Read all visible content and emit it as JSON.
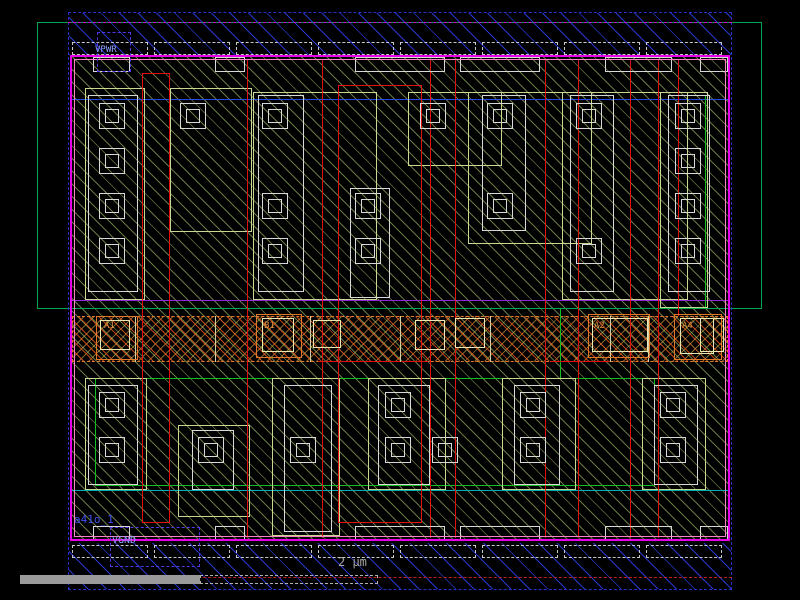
{
  "viewer": {
    "tool": "ic-layout-viewer",
    "cell_name": "a41o_1",
    "power_rails": [
      "VPWR",
      "VGND"
    ],
    "pin_labels": [
      "A1",
      "B1",
      "A2",
      "A4"
    ],
    "scale_bar": {
      "label": "2 μm"
    }
  },
  "colors": {
    "background": "#000000",
    "metal1_blue": "#2838d0",
    "boundary_blue": "#2830c8",
    "magenta_border": "#e800e8",
    "pink_inner": "#ff80c8",
    "magenta_dash": "#cc00cc",
    "red_dash": "#c02020",
    "nwell_green": "#00a850",
    "accent_green": "#10c020",
    "teal_line": "#00b0b0",
    "purple_line": "#9028d8",
    "blue_line": "#2848e8",
    "poly_red": "#e01010",
    "li_white": "#d8d8d8",
    "diff_tan": "#c8d890",
    "pin_bright": "#e8e8b0",
    "pin_orange": "#e07828",
    "label_orange": "#e09040",
    "label_blue": "#90a0ff",
    "cell_blue": "#4050f0",
    "ruler_gray": "#9a9a9a"
  },
  "shapes": [
    {
      "n": "m1-rail-top-hatch",
      "t": "rect",
      "x": 69,
      "y": 13,
      "w": 662,
      "h": 42,
      "f": "hb"
    },
    {
      "n": "m1-rail-bottom-hatch",
      "t": "rect",
      "x": 69,
      "y": 543,
      "w": 662,
      "h": 46,
      "f": "hb"
    },
    {
      "n": "cell-body-hatch",
      "t": "rect",
      "x": 72,
      "y": 57,
      "w": 656,
      "h": 484,
      "f": "hg"
    },
    {
      "n": "tap-band",
      "t": "rect",
      "x": 72,
      "y": 316,
      "w": 656,
      "h": 46,
      "f": "hx",
      "c": "#e07828",
      "s": "dashed"
    },
    {
      "n": "nwell-outline",
      "t": "rect",
      "x": 37,
      "y": 22,
      "w": 725,
      "h": 287,
      "c": "#00a850"
    },
    {
      "n": "implant-line-top",
      "t": "hline",
      "x": 72,
      "y": 99,
      "w": 656,
      "c": "#2848e8"
    },
    {
      "n": "well-boundary-line",
      "t": "hline",
      "x": 72,
      "y": 300,
      "w": 656,
      "c": "#9028d8"
    },
    {
      "n": "implant-line-bottom",
      "t": "hline",
      "x": 72,
      "y": 490,
      "w": 656,
      "c": "#00b0b0"
    },
    {
      "n": "green-edge-v1",
      "t": "vline",
      "x": 560,
      "y": 309,
      "h": 69,
      "c": "#10c020"
    },
    {
      "n": "green-edge-v2",
      "t": "vline",
      "x": 705,
      "y": 95,
      "h": 214,
      "c": "#10c020"
    },
    {
      "n": "lvt-region-outline",
      "t": "rect",
      "x": 95,
      "y": 378,
      "w": 560,
      "h": 108,
      "c": "#10c020"
    },
    {
      "n": "diff-outline-1",
      "t": "rect",
      "x": 85,
      "y": 88,
      "w": 60,
      "h": 212,
      "c": "#c8d890"
    },
    {
      "n": "diff-outline-2",
      "t": "rect",
      "x": 170,
      "y": 88,
      "w": 82,
      "h": 144,
      "c": "#c8d890"
    },
    {
      "n": "diff-outline-3",
      "t": "rect",
      "x": 253,
      "y": 92,
      "w": 124,
      "h": 208,
      "c": "#c8d890"
    },
    {
      "n": "diff-outline-4",
      "t": "rect",
      "x": 408,
      "y": 92,
      "w": 94,
      "h": 74,
      "c": "#c8d890"
    },
    {
      "n": "diff-outline-5",
      "t": "rect",
      "x": 468,
      "y": 92,
      "w": 124,
      "h": 152,
      "c": "#c8d890"
    },
    {
      "n": "diff-outline-6",
      "t": "rect",
      "x": 562,
      "y": 92,
      "w": 126,
      "h": 208,
      "c": "#c8d890"
    },
    {
      "n": "diff-outline-7",
      "t": "rect",
      "x": 660,
      "y": 92,
      "w": 48,
      "h": 216,
      "c": "#c8d890"
    },
    {
      "n": "diff-outline-8",
      "t": "rect",
      "x": 85,
      "y": 378,
      "w": 62,
      "h": 112,
      "c": "#c8d890"
    },
    {
      "n": "diff-outline-9",
      "t": "rect",
      "x": 178,
      "y": 425,
      "w": 72,
      "h": 92,
      "c": "#c8d890"
    },
    {
      "n": "diff-outline-10",
      "t": "rect",
      "x": 272,
      "y": 378,
      "w": 68,
      "h": 158,
      "c": "#c8d890"
    },
    {
      "n": "diff-outline-11",
      "t": "rect",
      "x": 368,
      "y": 378,
      "w": 78,
      "h": 112,
      "c": "#c8d890"
    },
    {
      "n": "diff-outline-12",
      "t": "rect",
      "x": 502,
      "y": 378,
      "w": 74,
      "h": 112,
      "c": "#c8d890"
    },
    {
      "n": "diff-outline-13",
      "t": "rect",
      "x": 642,
      "y": 378,
      "w": 64,
      "h": 112,
      "c": "#c8d890"
    },
    {
      "n": "poly-pad-pair-1",
      "t": "rect",
      "x": 142,
      "y": 73,
      "w": 28,
      "h": 450,
      "c": "#e01010"
    },
    {
      "n": "poly-pad-pair-2",
      "t": "rect",
      "x": 338,
      "y": 85,
      "w": 84,
      "h": 438,
      "c": "#e01010"
    },
    {
      "n": "poly-gate-1",
      "t": "vline",
      "x": 247,
      "y": 60,
      "h": 478,
      "c": "#e01010"
    },
    {
      "n": "poly-gate-2",
      "t": "vline",
      "x": 322,
      "y": 60,
      "h": 478,
      "c": "#e01010"
    },
    {
      "n": "poly-gate-3",
      "t": "vline",
      "x": 430,
      "y": 60,
      "h": 478,
      "c": "#e01010"
    },
    {
      "n": "poly-gate-4",
      "t": "vline",
      "x": 455,
      "y": 60,
      "h": 478,
      "c": "#e01010"
    },
    {
      "n": "poly-gate-5",
      "t": "vline",
      "x": 545,
      "y": 60,
      "h": 478,
      "c": "#e01010"
    },
    {
      "n": "poly-gate-6",
      "t": "vline",
      "x": 578,
      "y": 60,
      "h": 478,
      "c": "#e01010"
    },
    {
      "n": "poly-gate-7",
      "t": "vline",
      "x": 630,
      "y": 60,
      "h": 478,
      "c": "#e01010"
    },
    {
      "n": "poly-gate-8",
      "t": "vline",
      "x": 658,
      "y": 60,
      "h": 478,
      "c": "#e01010"
    },
    {
      "n": "poly-gate-9",
      "t": "vline",
      "x": 678,
      "y": 60,
      "h": 256,
      "c": "#e01010"
    },
    {
      "n": "poly-seg-1",
      "t": "hline",
      "x": 318,
      "y": 361,
      "w": 110,
      "c": "#e01010"
    },
    {
      "n": "poly-seg-2",
      "t": "hline",
      "x": 550,
      "y": 361,
      "w": 60,
      "c": "#e01010"
    },
    {
      "n": "li-finger-1",
      "t": "rect",
      "x": 88,
      "y": 95,
      "w": 50,
      "h": 197,
      "c": "#d8d8d8"
    },
    {
      "n": "li-finger-2",
      "t": "rect",
      "x": 258,
      "y": 95,
      "w": 46,
      "h": 197,
      "c": "#d8d8d8"
    },
    {
      "n": "li-finger-3",
      "t": "rect",
      "x": 350,
      "y": 188,
      "w": 40,
      "h": 110,
      "c": "#d8d8d8"
    },
    {
      "n": "li-finger-4",
      "t": "rect",
      "x": 482,
      "y": 95,
      "w": 44,
      "h": 136,
      "c": "#d8d8d8"
    },
    {
      "n": "li-finger-5",
      "t": "rect",
      "x": 570,
      "y": 95,
      "w": 44,
      "h": 197,
      "c": "#d8d8d8"
    },
    {
      "n": "li-finger-6",
      "t": "rect",
      "x": 668,
      "y": 95,
      "w": 42,
      "h": 197,
      "c": "#d8d8d8"
    },
    {
      "n": "li-finger-7",
      "t": "rect",
      "x": 88,
      "y": 385,
      "w": 50,
      "h": 100,
      "c": "#d8d8d8"
    },
    {
      "n": "li-finger-8",
      "t": "rect",
      "x": 192,
      "y": 430,
      "w": 42,
      "h": 60,
      "c": "#d8d8d8"
    },
    {
      "n": "li-finger-9",
      "t": "rect",
      "x": 284,
      "y": 385,
      "w": 48,
      "h": 147,
      "c": "#d8d8d8"
    },
    {
      "n": "li-finger-10",
      "t": "rect",
      "x": 378,
      "y": 385,
      "w": 52,
      "h": 100,
      "c": "#d8d8d8"
    },
    {
      "n": "li-finger-11",
      "t": "rect",
      "x": 514,
      "y": 385,
      "w": 46,
      "h": 100,
      "c": "#d8d8d8"
    },
    {
      "n": "li-finger-12",
      "t": "rect",
      "x": 654,
      "y": 385,
      "w": 44,
      "h": 100,
      "c": "#d8d8d8"
    },
    {
      "n": "rail-tab-t1",
      "t": "rect",
      "x": 93,
      "y": 57,
      "w": 37,
      "h": 15,
      "c": "#d8d8d8"
    },
    {
      "n": "rail-tab-t2",
      "t": "rect",
      "x": 215,
      "y": 57,
      "w": 30,
      "h": 15,
      "c": "#d8d8d8"
    },
    {
      "n": "rail-tab-t3",
      "t": "rect",
      "x": 355,
      "y": 57,
      "w": 90,
      "h": 15,
      "c": "#d8d8d8"
    },
    {
      "n": "rail-tab-t4",
      "t": "rect",
      "x": 460,
      "y": 57,
      "w": 80,
      "h": 15,
      "c": "#d8d8d8"
    },
    {
      "n": "rail-tab-t5",
      "t": "rect",
      "x": 605,
      "y": 57,
      "w": 67,
      "h": 15,
      "c": "#d8d8d8"
    },
    {
      "n": "rail-tab-t6",
      "t": "rect",
      "x": 700,
      "y": 57,
      "w": 28,
      "h": 15,
      "c": "#d8d8d8"
    },
    {
      "n": "rail-tab-b1",
      "t": "rect",
      "x": 93,
      "y": 526,
      "w": 37,
      "h": 15,
      "c": "#d8d8d8"
    },
    {
      "n": "rail-tab-b2",
      "t": "rect",
      "x": 215,
      "y": 526,
      "w": 30,
      "h": 15,
      "c": "#d8d8d8"
    },
    {
      "n": "rail-tab-b3",
      "t": "rect",
      "x": 355,
      "y": 526,
      "w": 90,
      "h": 15,
      "c": "#d8d8d8"
    },
    {
      "n": "rail-tab-b4",
      "t": "rect",
      "x": 460,
      "y": 526,
      "w": 80,
      "h": 15,
      "c": "#d8d8d8"
    },
    {
      "n": "rail-tab-b5",
      "t": "rect",
      "x": 605,
      "y": 526,
      "w": 67,
      "h": 15,
      "c": "#d8d8d8"
    },
    {
      "n": "rail-tab-b6",
      "t": "rect",
      "x": 700,
      "y": 526,
      "w": 28,
      "h": 15,
      "c": "#d8d8d8"
    },
    {
      "n": "tap-vline-1",
      "t": "vline",
      "x": 135,
      "y": 316,
      "h": 46,
      "c": "#d0d0a0"
    },
    {
      "n": "tap-vline-2",
      "t": "vline",
      "x": 215,
      "y": 316,
      "h": 46,
      "c": "#d0d0a0"
    },
    {
      "n": "tap-vline-3",
      "t": "vline",
      "x": 310,
      "y": 316,
      "h": 46,
      "c": "#d0d0a0"
    },
    {
      "n": "tap-vline-4",
      "t": "vline",
      "x": 400,
      "y": 316,
      "h": 46,
      "c": "#d0d0a0"
    },
    {
      "n": "tap-vline-5",
      "t": "vline",
      "x": 490,
      "y": 316,
      "h": 46,
      "c": "#d0d0a0"
    },
    {
      "n": "tap-vline-6",
      "t": "vline",
      "x": 610,
      "y": 316,
      "h": 46,
      "c": "#d0d0a0"
    },
    {
      "n": "tap-vline-7",
      "t": "vline",
      "x": 648,
      "y": 316,
      "h": 46,
      "c": "#d0d0a0"
    },
    {
      "n": "contact",
      "t": "sq",
      "x": 99,
      "y": 103
    },
    {
      "n": "contact",
      "t": "sq",
      "x": 99,
      "y": 148
    },
    {
      "n": "contact",
      "t": "sq",
      "x": 99,
      "y": 193
    },
    {
      "n": "contact",
      "t": "sq",
      "x": 99,
      "y": 238
    },
    {
      "n": "contact",
      "t": "sq",
      "x": 180,
      "y": 103
    },
    {
      "n": "contact",
      "t": "sq",
      "x": 262,
      "y": 103
    },
    {
      "n": "contact",
      "t": "sq",
      "x": 262,
      "y": 193
    },
    {
      "n": "contact",
      "t": "sq",
      "x": 262,
      "y": 238
    },
    {
      "n": "contact",
      "t": "sq",
      "x": 355,
      "y": 193
    },
    {
      "n": "contact",
      "t": "sq",
      "x": 355,
      "y": 238
    },
    {
      "n": "contact",
      "t": "sq",
      "x": 420,
      "y": 103
    },
    {
      "n": "contact",
      "t": "sq",
      "x": 487,
      "y": 103
    },
    {
      "n": "contact",
      "t": "sq",
      "x": 487,
      "y": 193
    },
    {
      "n": "contact",
      "t": "sq",
      "x": 576,
      "y": 103
    },
    {
      "n": "contact",
      "t": "sq",
      "x": 576,
      "y": 238
    },
    {
      "n": "contact",
      "t": "sq",
      "x": 675,
      "y": 103
    },
    {
      "n": "contact",
      "t": "sq",
      "x": 675,
      "y": 148
    },
    {
      "n": "contact",
      "t": "sq",
      "x": 675,
      "y": 193
    },
    {
      "n": "contact",
      "t": "sq",
      "x": 675,
      "y": 238
    },
    {
      "n": "contact",
      "t": "sq",
      "x": 99,
      "y": 392
    },
    {
      "n": "contact",
      "t": "sq",
      "x": 99,
      "y": 437
    },
    {
      "n": "contact",
      "t": "sq",
      "x": 198,
      "y": 437
    },
    {
      "n": "contact",
      "t": "sq",
      "x": 290,
      "y": 437
    },
    {
      "n": "contact",
      "t": "sq",
      "x": 385,
      "y": 392
    },
    {
      "n": "contact",
      "t": "sq",
      "x": 385,
      "y": 437
    },
    {
      "n": "contact",
      "t": "sq",
      "x": 432,
      "y": 437
    },
    {
      "n": "contact",
      "t": "sq",
      "x": 520,
      "y": 392
    },
    {
      "n": "contact",
      "t": "sq",
      "x": 520,
      "y": 437
    },
    {
      "n": "contact",
      "t": "sq",
      "x": 660,
      "y": 392
    },
    {
      "n": "contact",
      "t": "sq",
      "x": 660,
      "y": 437
    },
    {
      "n": "pin-box-a1",
      "t": "rect",
      "x": 96,
      "y": 316,
      "w": 42,
      "h": 44,
      "c": "#e07828"
    },
    {
      "n": "pin-box-b1",
      "t": "rect",
      "x": 256,
      "y": 314,
      "w": 46,
      "h": 44,
      "c": "#e07828"
    },
    {
      "n": "pin-box-a2",
      "t": "rect",
      "x": 588,
      "y": 314,
      "w": 62,
      "h": 44,
      "c": "#e07828"
    },
    {
      "n": "pin-box-a4",
      "t": "rect",
      "x": 674,
      "y": 314,
      "w": 48,
      "h": 46,
      "c": "#e07828"
    },
    {
      "n": "pin-li-a1",
      "t": "rect",
      "x": 100,
      "y": 320,
      "w": 30,
      "h": 30,
      "c": "#e8e8b0"
    },
    {
      "n": "pin-li-b1",
      "t": "rect",
      "x": 262,
      "y": 318,
      "w": 32,
      "h": 34,
      "c": "#e8e8b0"
    },
    {
      "n": "pin-li-a2",
      "t": "rect",
      "x": 592,
      "y": 318,
      "w": 56,
      "h": 34,
      "c": "#e8e8b0"
    },
    {
      "n": "pin-li-a4",
      "t": "rect",
      "x": 680,
      "y": 318,
      "w": 34,
      "h": 36,
      "c": "#e8e8b0"
    },
    {
      "n": "tap-li-1",
      "t": "rect",
      "x": 313,
      "y": 320,
      "w": 28,
      "h": 28,
      "c": "#e8e8b0"
    },
    {
      "n": "tap-li-2",
      "t": "rect",
      "x": 415,
      "y": 320,
      "w": 30,
      "h": 30,
      "c": "#e8e8b0"
    },
    {
      "n": "tap-li-3",
      "t": "rect",
      "x": 455,
      "y": 318,
      "w": 30,
      "h": 30,
      "c": "#e8e8b0"
    },
    {
      "n": "tap-li-4",
      "t": "rect",
      "x": 700,
      "y": 318,
      "w": 24,
      "h": 34,
      "c": "#e8e8b0"
    },
    {
      "n": "cell-border-magenta",
      "t": "rect",
      "x": 70,
      "y": 55,
      "w": 660,
      "h": 486,
      "c": "#e800e8",
      "bw": 2
    },
    {
      "n": "cell-border-pink",
      "t": "rect",
      "x": 74,
      "y": 59,
      "w": 652,
      "h": 478,
      "c": "#ff80c8"
    },
    {
      "n": "boundary-blue-dashed",
      "t": "rect",
      "x": 68,
      "y": 12,
      "w": 664,
      "h": 578,
      "c": "#2830c8",
      "s": "dashed"
    },
    {
      "n": "rail-centerline-top",
      "t": "hdash",
      "x": 68,
      "y": 22,
      "w": 664,
      "c": "#cc00cc"
    },
    {
      "n": "rail-centerline-bottom",
      "t": "hdash",
      "x": 68,
      "y": 577,
      "w": 664,
      "c": "#c02020"
    },
    {
      "n": "mcon-row-t1",
      "t": "rect",
      "x": 72,
      "y": 42,
      "w": 76,
      "h": 13,
      "c": "#c8c8c8",
      "s": "dashed"
    },
    {
      "n": "mcon-row-t2",
      "t": "rect",
      "x": 154,
      "y": 42,
      "w": 76,
      "h": 13,
      "c": "#c8c8c8",
      "s": "dashed"
    },
    {
      "n": "mcon-row-t3",
      "t": "rect",
      "x": 236,
      "y": 42,
      "w": 76,
      "h": 13,
      "c": "#c8c8c8",
      "s": "dashed"
    },
    {
      "n": "mcon-row-t4",
      "t": "rect",
      "x": 318,
      "y": 42,
      "w": 76,
      "h": 13,
      "c": "#c8c8c8",
      "s": "dashed"
    },
    {
      "n": "mcon-row-t5",
      "t": "rect",
      "x": 400,
      "y": 42,
      "w": 76,
      "h": 13,
      "c": "#c8c8c8",
      "s": "dashed"
    },
    {
      "n": "mcon-row-t6",
      "t": "rect",
      "x": 482,
      "y": 42,
      "w": 76,
      "h": 13,
      "c": "#c8c8c8",
      "s": "dashed"
    },
    {
      "n": "mcon-row-t7",
      "t": "rect",
      "x": 564,
      "y": 42,
      "w": 76,
      "h": 13,
      "c": "#c8c8c8",
      "s": "dashed"
    },
    {
      "n": "mcon-row-t8",
      "t": "rect",
      "x": 646,
      "y": 42,
      "w": 76,
      "h": 13,
      "c": "#c8c8c8",
      "s": "dashed"
    },
    {
      "n": "mcon-row-b1",
      "t": "rect",
      "x": 72,
      "y": 545,
      "w": 76,
      "h": 13,
      "c": "#c8c8c8",
      "s": "dashed"
    },
    {
      "n": "mcon-row-b2",
      "t": "rect",
      "x": 154,
      "y": 545,
      "w": 76,
      "h": 13,
      "c": "#c8c8c8",
      "s": "dashed"
    },
    {
      "n": "mcon-row-b3",
      "t": "rect",
      "x": 236,
      "y": 545,
      "w": 76,
      "h": 13,
      "c": "#c8c8c8",
      "s": "dashed"
    },
    {
      "n": "mcon-row-b4",
      "t": "rect",
      "x": 318,
      "y": 545,
      "w": 76,
      "h": 13,
      "c": "#c8c8c8",
      "s": "dashed"
    },
    {
      "n": "mcon-row-b5",
      "t": "rect",
      "x": 400,
      "y": 545,
      "w": 76,
      "h": 13,
      "c": "#c8c8c8",
      "s": "dashed"
    },
    {
      "n": "mcon-row-b6",
      "t": "rect",
      "x": 482,
      "y": 545,
      "w": 76,
      "h": 13,
      "c": "#c8c8c8",
      "s": "dashed"
    },
    {
      "n": "mcon-row-b7",
      "t": "rect",
      "x": 564,
      "y": 545,
      "w": 76,
      "h": 13,
      "c": "#c8c8c8",
      "s": "dashed"
    },
    {
      "n": "mcon-row-b8",
      "t": "rect",
      "x": 646,
      "y": 545,
      "w": 76,
      "h": 13,
      "c": "#c8c8c8",
      "s": "dashed"
    },
    {
      "n": "vpwr-pin-box",
      "t": "rect",
      "x": 97,
      "y": 32,
      "w": 34,
      "h": 40,
      "c": "#5038e8",
      "s": "dashed"
    },
    {
      "n": "vgnd-pin-box",
      "t": "rect",
      "x": 110,
      "y": 527,
      "w": 90,
      "h": 40,
      "c": "#5038e8",
      "s": "dashed"
    },
    {
      "n": "scalebar-solid",
      "t": "fill",
      "x": 20,
      "y": 575,
      "w": 180,
      "h": 9,
      "bg": "#9a9a9a"
    },
    {
      "n": "scalebar-outline",
      "t": "rect",
      "x": 200,
      "y": 575,
      "w": 178,
      "h": 9,
      "c": "#b0b0b0",
      "s": "dashed"
    }
  ],
  "texts": [
    {
      "n": "vpwr-label",
      "text": "VPWR",
      "x": 95,
      "y": 46,
      "c": "#90a0ff",
      "size": 9
    },
    {
      "n": "cell-name-label",
      "text": "a41o_1",
      "x": 74,
      "y": 514,
      "c": "#4050f0",
      "size": 11
    },
    {
      "n": "vgnd-label",
      "text": "VGND",
      "x": 112,
      "y": 536,
      "c": "#90a0ff",
      "size": 10
    },
    {
      "n": "pin-label-a1",
      "text": "A1",
      "x": 104,
      "y": 322,
      "c": "#e09040",
      "size": 9
    },
    {
      "n": "pin-label-b1",
      "text": "B1",
      "x": 264,
      "y": 322,
      "c": "#e09040",
      "size": 9
    },
    {
      "n": "pin-label-a2",
      "text": "A2",
      "x": 594,
      "y": 322,
      "c": "#e09040",
      "size": 9
    },
    {
      "n": "pin-label-a4",
      "text": "A4",
      "x": 682,
      "y": 322,
      "c": "#e09040",
      "size": 9
    },
    {
      "n": "scalebar-label",
      "text": "2 μm",
      "x": 338,
      "y": 556,
      "c": "#a8a8a8",
      "size": 12
    }
  ]
}
